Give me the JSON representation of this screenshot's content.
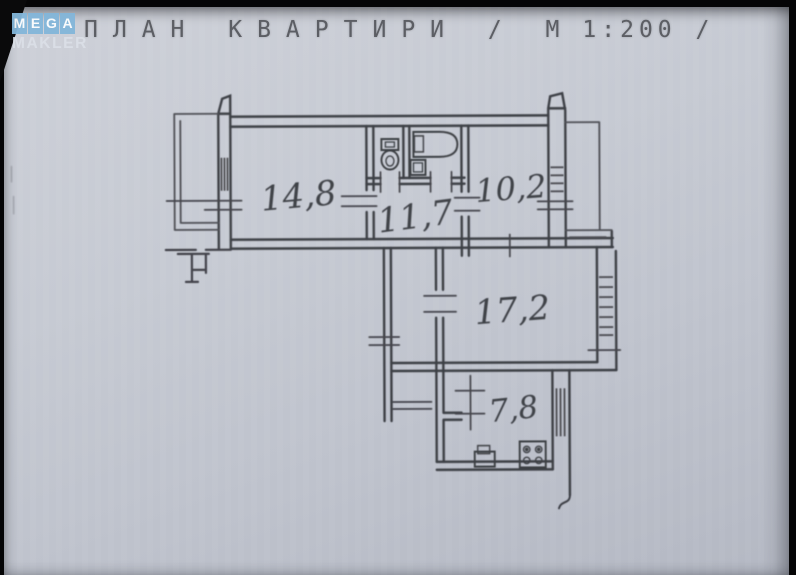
{
  "watermark_logo": {
    "tiles": [
      "M",
      "E",
      "G",
      "A"
    ],
    "subtitle": "MAKLER",
    "tile_color": "#83b6da"
  },
  "title": {
    "full_text": "ПЛАН КВАРТИРИ / М 1:200 /",
    "part1": "ПЛАН КВАРТИРИ / М",
    "part2": "1:200 /",
    "scale": "1:200"
  },
  "floorplan": {
    "type": "apartment-plan",
    "ink_color": "#34353b",
    "paper_color": "#c4c8d1",
    "rooms": [
      {
        "id": "room-14-8",
        "area_label": "14,8",
        "area_m2": 14.8
      },
      {
        "id": "room-11-7",
        "area_label": "11,7",
        "area_m2": 11.7
      },
      {
        "id": "room-10-2",
        "area_label": "10,2",
        "area_m2": 10.2
      },
      {
        "id": "room-17-2",
        "area_label": "17,2",
        "area_m2": 17.2
      },
      {
        "id": "room-7-8",
        "area_label": "7,8",
        "area_m2": 7.8
      }
    ]
  }
}
